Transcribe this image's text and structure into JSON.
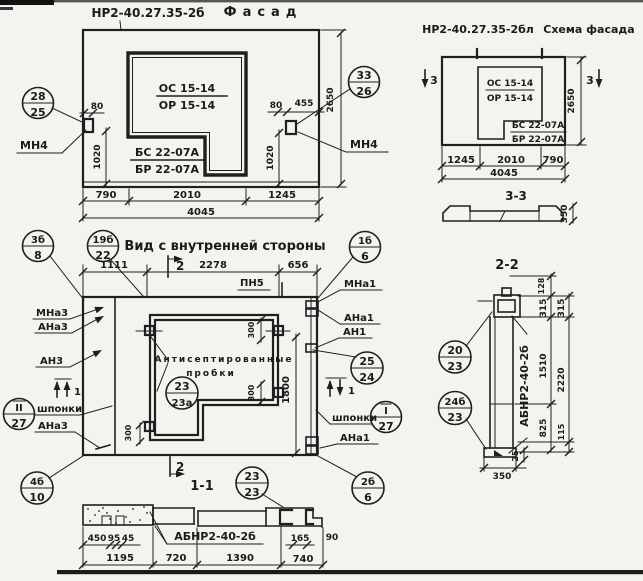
{
  "colors": {
    "ink": "#1f1f1f",
    "paper": "#f4f3ef"
  },
  "facade": {
    "mark": "НР2-40.27.35-2б",
    "title": "Фасад",
    "window_top": "ОС 15-14",
    "window_bot": "ОР 15-14",
    "door_top": "БС 22-07А",
    "door_bot": "БР 22-07А",
    "callout_left": {
      "num": "28",
      "den": "25"
    },
    "callout_right": {
      "num": "33",
      "den": "26"
    },
    "anchor": "МН4",
    "dims": {
      "d80l": "80",
      "d1020l": "1020",
      "d80r": "80",
      "d455": "455",
      "d1020r": "1020",
      "d2650": "2650",
      "d790": "790",
      "d2010": "2010",
      "d1245": "1245",
      "d4045": "4045"
    }
  },
  "schema": {
    "mark": "НР2-40.27.35-2бл",
    "title": "Схема фасада",
    "window_top": "ОС 15-14",
    "window_bot": "ОР 15-14",
    "door_top": "БС 22-07А",
    "door_bot": "БР 22-07А",
    "cut3": "3",
    "dims": {
      "d2650": "2650",
      "d1245": "1245",
      "d2010": "2010",
      "d790": "790",
      "d4045": "4045"
    },
    "section33": {
      "title": "3-3",
      "d350": "350"
    }
  },
  "inner": {
    "title": "Вид с внутренней стороны",
    "callouts": {
      "c3b8": {
        "num": "3б",
        "den": "8"
      },
      "c19b22": {
        "num": "19б",
        "den": "22"
      },
      "c1b6": {
        "num": "1б",
        "den": "6"
      },
      "c2524": {
        "num": "25",
        "den": "24"
      },
      "c2323a": {
        "num": "23",
        "den": "23а"
      },
      "cII27": {
        "num": "II",
        "den": "27"
      },
      "cI27": {
        "num": "I",
        "den": "27"
      },
      "c4b10": {
        "num": "4б",
        "den": "10"
      },
      "c2b6": {
        "num": "2б",
        "den": "6"
      }
    },
    "labels": {
      "pn5": "ПН5",
      "mna1": "МНа1",
      "ana1": "АНа1",
      "an1": "АН1",
      "mna3": "МНа3",
      "ana3": "АНа3",
      "an3": "АН3",
      "shponki": "шпонки",
      "plugs1": "Антисептированные",
      "plugs2": "пробки"
    },
    "cut1": "1",
    "cut2": "2",
    "dims": {
      "d1111": "1111",
      "d2278": "2278",
      "d656": "656",
      "d1800": "1800",
      "d300": "300"
    }
  },
  "section11": {
    "title": "1-1",
    "label": "АБНР2-40-2б",
    "callout": {
      "num": "23",
      "den": "23"
    },
    "dims": {
      "d450": "450",
      "d95": "95",
      "d45": "45",
      "d165": "165",
      "d90": "90",
      "d1195": "1195",
      "d720": "720",
      "d1390": "1390",
      "d740": "740"
    }
  },
  "section22": {
    "title": "2-2",
    "label": "АБНР2-40-2б",
    "callouts": {
      "c2023": {
        "num": "20",
        "den": "23"
      },
      "c24b23": {
        "num": "24б",
        "den": "23"
      }
    },
    "dims": {
      "d128": "128",
      "d315a": "315",
      "d315b": "315",
      "d1510": "1510",
      "d2220": "2220",
      "d825": "825",
      "d115": "115",
      "d25": "25",
      "d350": "350"
    }
  }
}
